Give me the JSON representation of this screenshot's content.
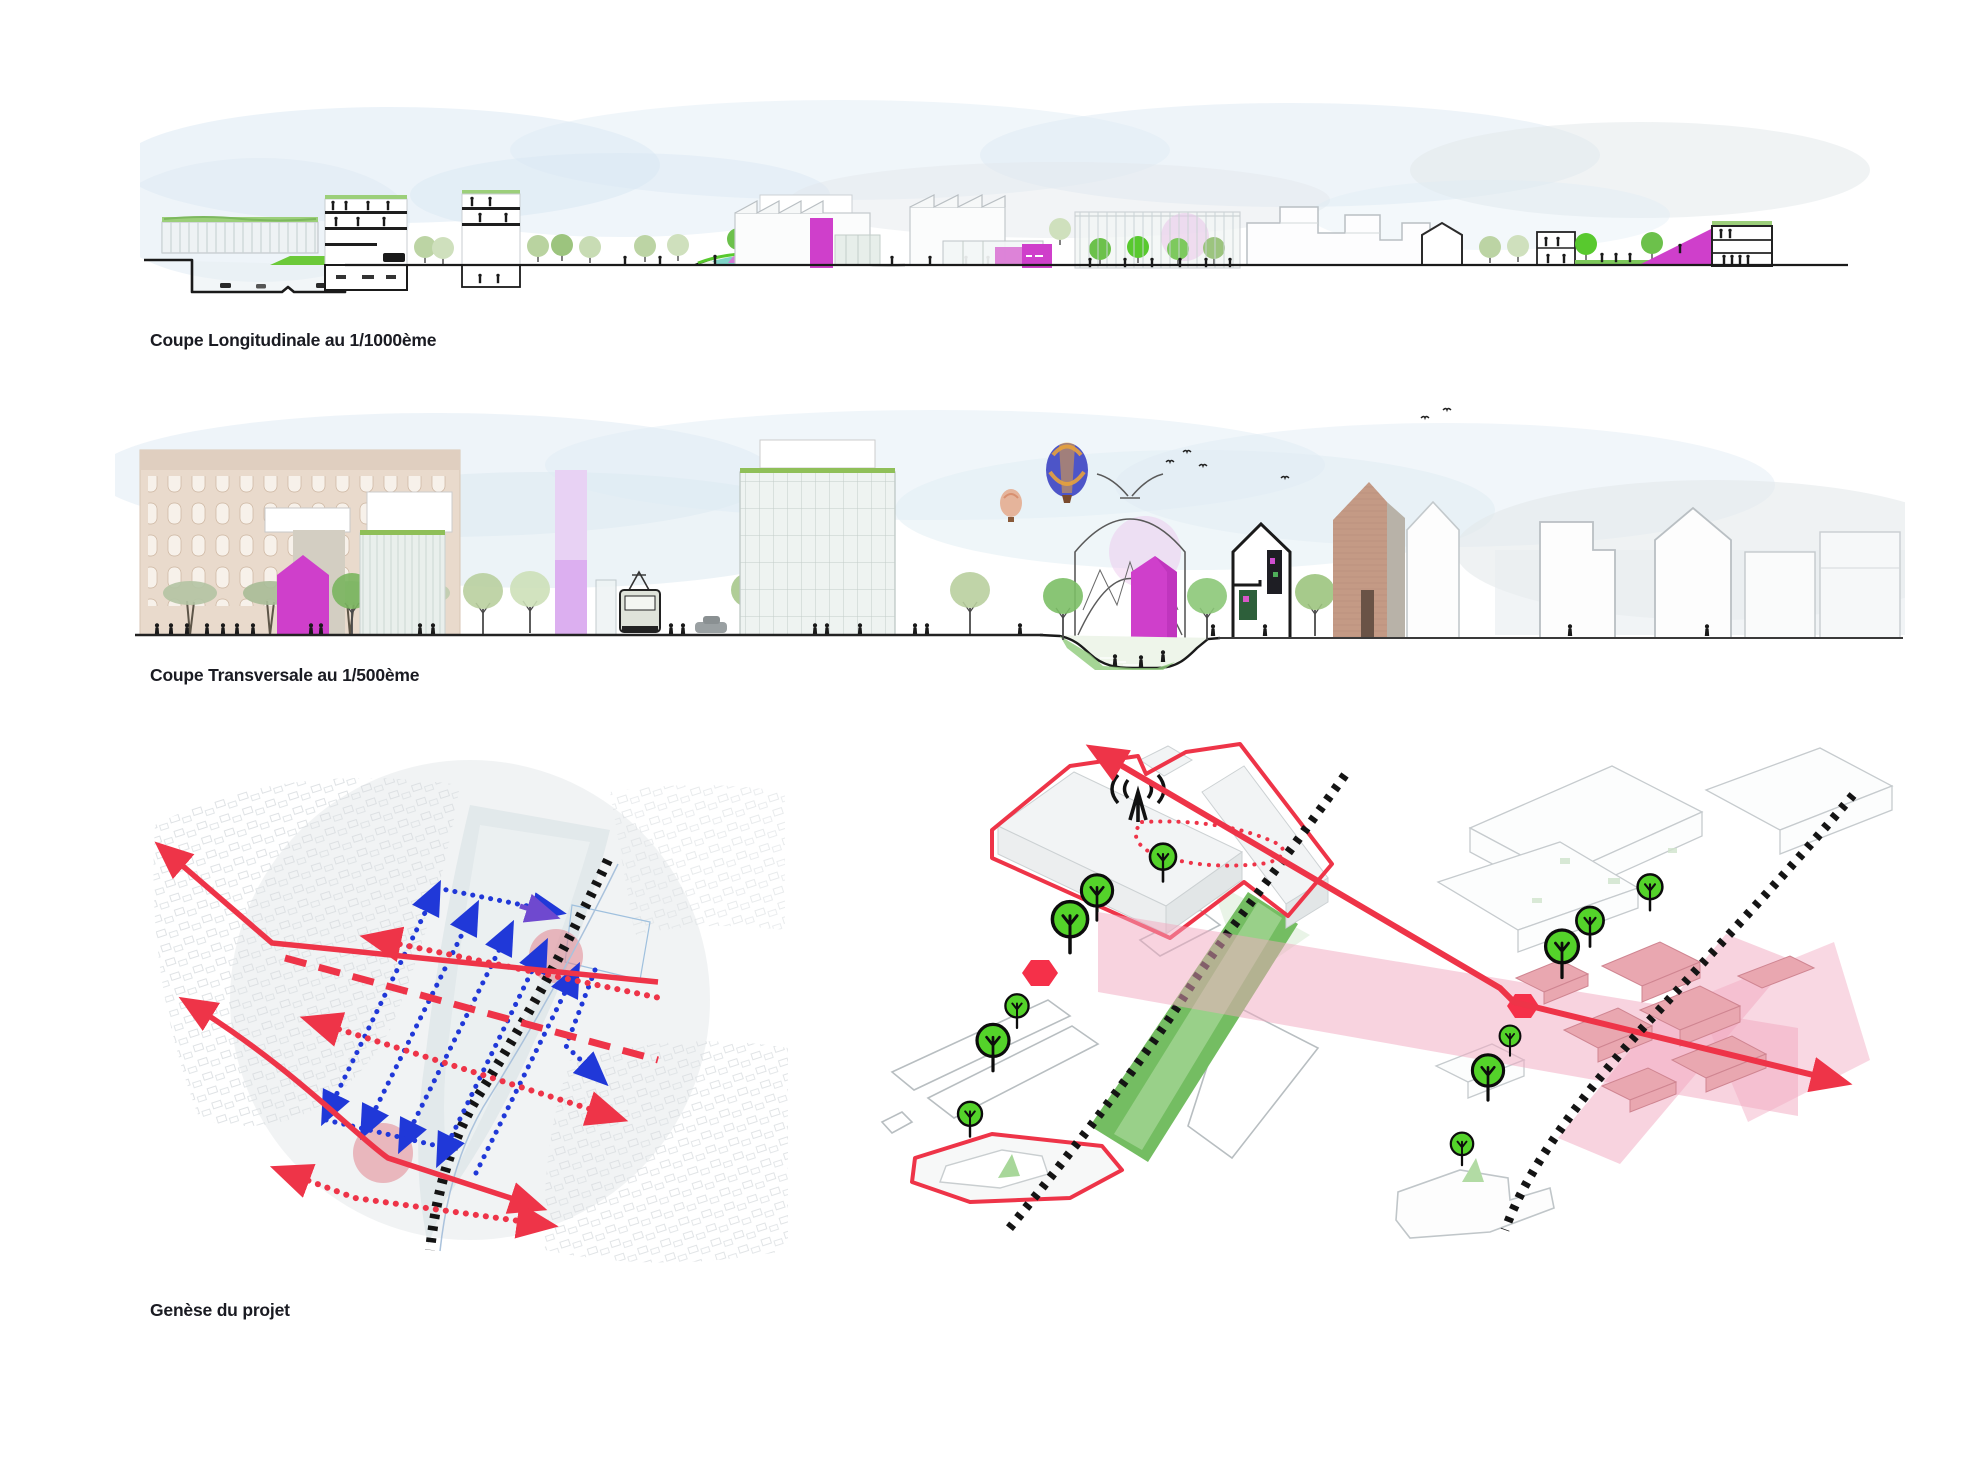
{
  "board": {
    "width": 1966,
    "height": 1475,
    "background": "#ffffff"
  },
  "captions": {
    "longitudinal": {
      "label": "Coupe Longitudinale au 1/1000ème"
    },
    "transversale": {
      "label": "Coupe Transversale au 1/500ème"
    },
    "genese": {
      "label": "Genèse du projet"
    }
  },
  "figures": {
    "longitudinal_section": {
      "name": "Coupe Longitudinale",
      "scale": "1/1000"
    },
    "transversal_section": {
      "name": "Coupe Transversale",
      "scale": "1/500"
    },
    "genesis_diagrams": {
      "name": "Genèse du projet",
      "panels": 3
    }
  },
  "icons": {
    "tree": "tree-icon",
    "antenna": "broadcast-antenna-icon",
    "railway": "railway-dashed-line",
    "balloon": "hot-air-balloon-icon",
    "person": "person-silhouette-icon",
    "bird": "bird-icon",
    "tram": "tram-icon",
    "cyclist": "cyclist-icon"
  },
  "colors": {
    "caption-ink": "#1a1b22",
    "magenta": "#cf3fcb",
    "magenta-dark": "#b52fb5",
    "red": "#ee3448",
    "red-bright": "#f53049",
    "blue": "#2038d8",
    "violet": "#6f49cf",
    "tree-green": "#54d32a",
    "tree-stroke": "#0c0c0c",
    "band-green": "#74bd62",
    "band-green-light": "#a3d494",
    "pink-zone": "#f2a8c0",
    "pink-building": "#e9a7b0",
    "pink-node": "#e2858f",
    "sky": "#ddeaf4",
    "sky-gray": "#e2e7ea",
    "ground": "#1a1a1a",
    "outline-gray": "#c6cbce",
    "rail-black": "#141414",
    "brick": "#e9dacc",
    "brick-gable": "#c49a85",
    "glass": "#eef3f1",
    "pond-teal": "#7fd4c8",
    "grass": "#6cc939",
    "roof-green": "#9ccf7a",
    "balloon-blue": "#4d55c8",
    "balloon-orange": "#e8a23c",
    "balloon-small": "#e5b49b",
    "pink-tower-top": "#e8d2f4",
    "pink-tower-bottom": "#dcaff0",
    "pink-wash": "#eac4ea"
  }
}
